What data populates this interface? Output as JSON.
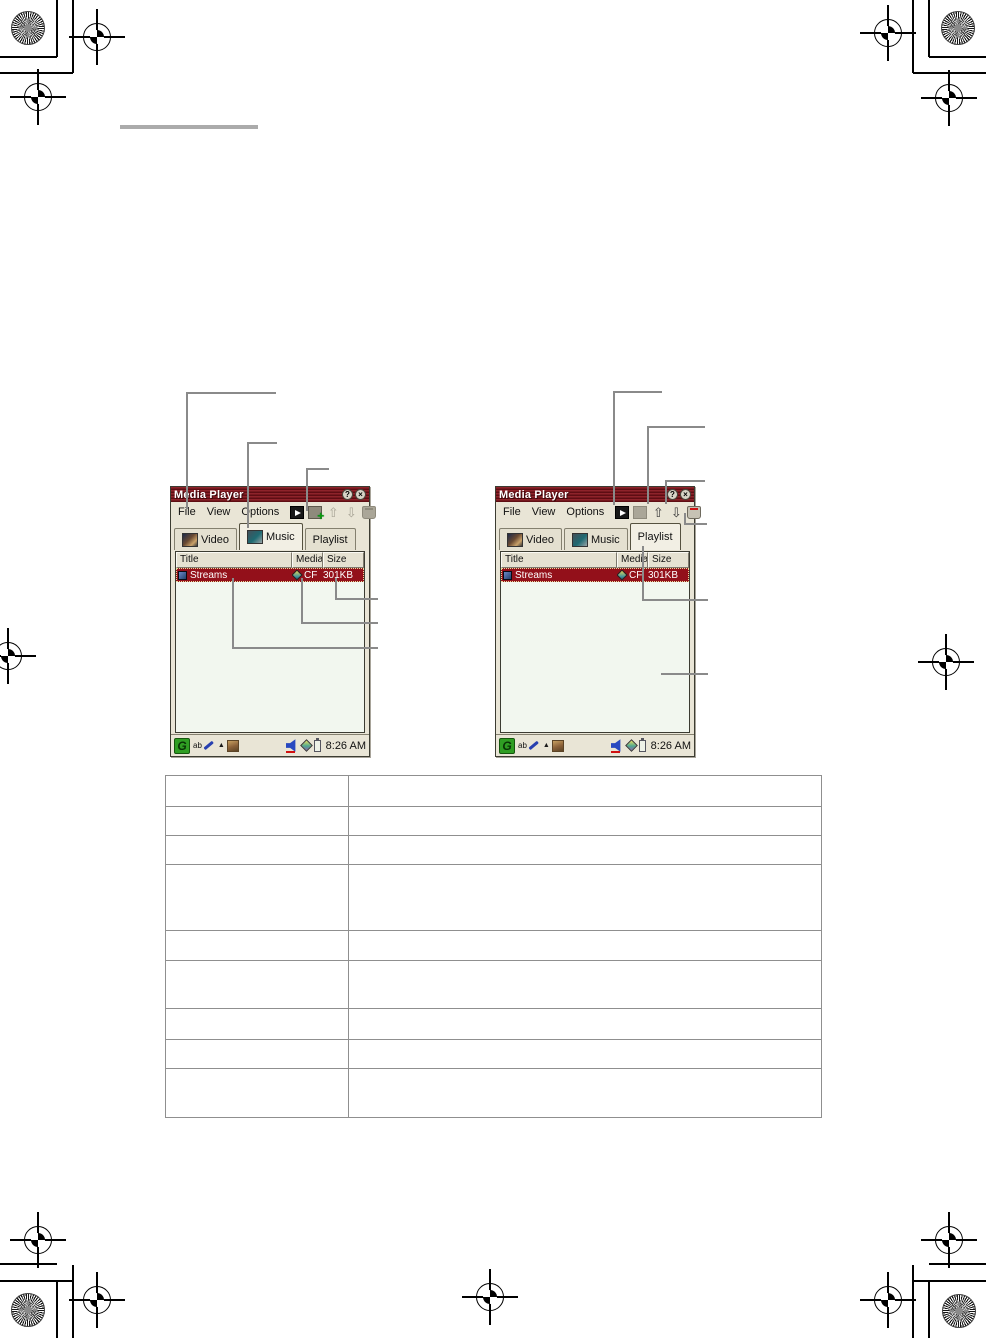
{
  "windows": [
    {
      "title": "Media Player",
      "help_label": "?",
      "close_label": "×",
      "menu": {
        "file": "File",
        "view": "View",
        "options": "Options"
      },
      "toolbar_icons": [
        "play",
        "add-to-playlist",
        "move-up",
        "move-down",
        "delete"
      ],
      "tabs": {
        "video": "Video",
        "music": "Music",
        "playlist": "Playlist"
      },
      "selected_tab": "Music",
      "columns": {
        "title": "Title",
        "media": "Media",
        "size": "Size"
      },
      "row": {
        "title": "Streams",
        "media": "CF",
        "size": "301KB"
      },
      "taskbar": {
        "logo": "G",
        "input_label": "ab",
        "time": "8:26 AM"
      }
    },
    {
      "title": "Media Player",
      "help_label": "?",
      "close_label": "×",
      "menu": {
        "file": "File",
        "view": "View",
        "options": "Options"
      },
      "toolbar_icons": [
        "play",
        "add-to-playlist",
        "move-up",
        "move-down",
        "delete"
      ],
      "tabs": {
        "video": "Video",
        "music": "Music",
        "playlist": "Playlist"
      },
      "selected_tab": "Playlist",
      "columns": {
        "title": "Title",
        "media": "Media",
        "size": "Size"
      },
      "row": {
        "title": "Streams",
        "media": "CF",
        "size": "301KB"
      },
      "taskbar": {
        "logo": "G",
        "input_label": "ab",
        "time": "8:26 AM"
      }
    }
  ],
  "reference_table": {
    "rows": 9,
    "columns": 2
  },
  "colors": {
    "titlebar": "#6b1016",
    "selection": "#93101a",
    "window_bg": "#e9e5d6",
    "list_bg": "#f2f7ef",
    "callout_line": "#8a8a8a"
  }
}
